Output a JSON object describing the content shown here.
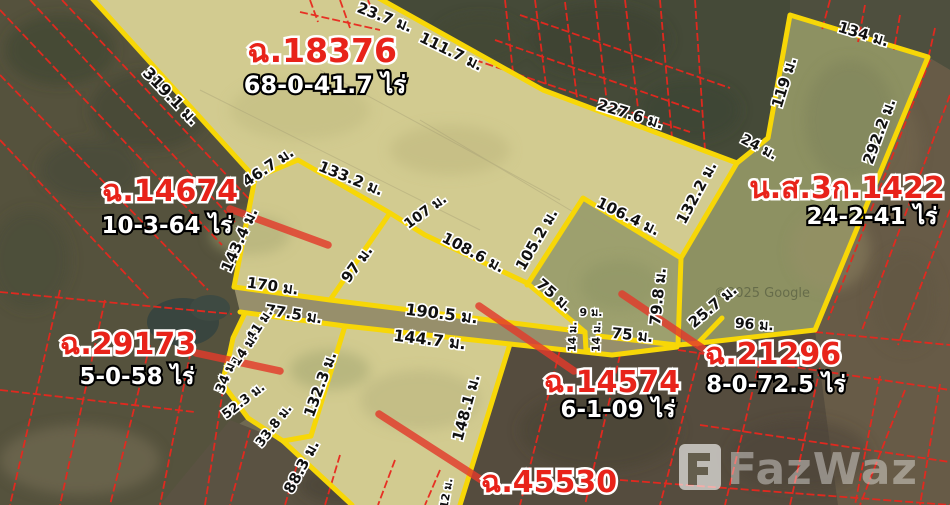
{
  "parcels": {
    "p18376": {
      "id": "ฉ.18376",
      "area": "68-0-41.7 ไร่"
    },
    "p14674": {
      "id": "ฉ.14674",
      "area": "10-3-64 ไร่"
    },
    "ns3k1422": {
      "id": "น.ส.3ก.1422",
      "area": "24-2-41 ไร่"
    },
    "p29173": {
      "id": "ฉ.29173",
      "area": "5-0-58 ไร่"
    },
    "p14574": {
      "id": "ฉ.14574",
      "area": "6-1-09 ไร่"
    },
    "p21296": {
      "id": "ฉ.21296",
      "area": "8-0-72.5 ไร่"
    },
    "p45530": {
      "id": "ฉ.45530"
    }
  },
  "measurements": [
    {
      "t": "319.1 ม."
    },
    {
      "t": "23.7 ม."
    },
    {
      "t": "111.7 ม."
    },
    {
      "t": "227.6 ม."
    },
    {
      "t": "134 ม."
    },
    {
      "t": "119 ม."
    },
    {
      "t": "24 ม."
    },
    {
      "t": "292.2 ม."
    },
    {
      "t": "46.7 ม."
    },
    {
      "t": "133.2 ม."
    },
    {
      "t": "107 ม."
    },
    {
      "t": "108.6 ม."
    },
    {
      "t": "105.2 ม."
    },
    {
      "t": "106.4 ม."
    },
    {
      "t": "132.2 ม."
    },
    {
      "t": "143.4 ม."
    },
    {
      "t": "97 ม."
    },
    {
      "t": "170 ม."
    },
    {
      "t": "77.5 ม."
    },
    {
      "t": "190.5 ม."
    },
    {
      "t": "144.7 ม."
    },
    {
      "t": "75 ม."
    },
    {
      "t": "9 ม."
    },
    {
      "t": "14 ม."
    },
    {
      "t": "14 ม."
    },
    {
      "t": "75 ม."
    },
    {
      "t": "79.8 ม."
    },
    {
      "t": "25.7 ม."
    },
    {
      "t": "96 ม."
    },
    {
      "t": "41 ม."
    },
    {
      "t": "14 ม."
    },
    {
      "t": "34 ม."
    },
    {
      "t": "52.3 ม."
    },
    {
      "t": "33.8 ม."
    },
    {
      "t": "132.3 ม."
    },
    {
      "t": "88.3 ม."
    },
    {
      "t": "148.1 ม."
    },
    {
      "t": "12 ม."
    }
  ],
  "watermark": {
    "brand": "FazWaz",
    "attribution": "©2025 Google"
  },
  "colors": {
    "boundary": "#f7d707",
    "cadastral": "#e8281e",
    "leader": "#e23b2b",
    "parcel_id": "#e8231a"
  }
}
